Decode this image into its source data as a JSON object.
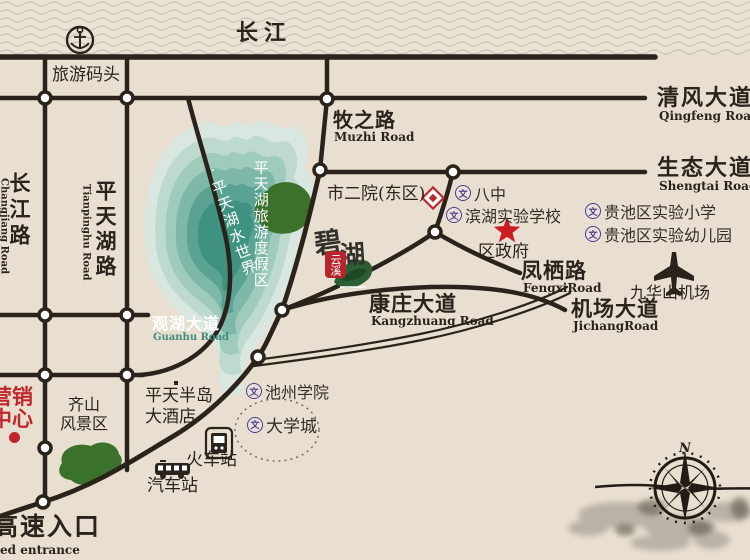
{
  "map": {
    "river": {
      "label": "长江"
    },
    "dock": {
      "label": "旅游码头"
    },
    "roads": {
      "muzhi": {
        "zh": "牧之路",
        "en": "Muzhi Road"
      },
      "qingfeng": {
        "zh": "清风大道",
        "en": "Qingfeng Road"
      },
      "shengtai": {
        "zh": "生态大道",
        "en": "Shengtai Road"
      },
      "changjiang": {
        "zh": "长江路",
        "en": "Changjiang Road"
      },
      "tianpinghu": {
        "zh": "平天湖路",
        "en": "Tianpinghu Road"
      },
      "guanhu": {
        "zh": "观湖大道",
        "en": "Guanhu Road"
      },
      "fengxi": {
        "zh": "凤栖路",
        "en": "FengxiRoad"
      },
      "jichang": {
        "zh": "机场大道",
        "en": "JichangRoad"
      },
      "kangzhuang": {
        "zh": "康庄大道",
        "en": "Kangzhuang Road"
      }
    },
    "lake": {
      "text1": "·平天湖水世界",
      "text2": "平天湖旅游度假区"
    },
    "pois": {
      "hospital": "市二院(东区)",
      "school_bazhong": "八中",
      "school_binhu": "滨湖实验学校",
      "school_primary": "贵池区实验小学",
      "school_kindergarten": "贵池区实验幼儿园",
      "government": "区政府",
      "airport": "九华山机场",
      "college": "池州学院",
      "university_town": "大学城",
      "train_station": "火车站",
      "bus_station": "汽车站",
      "hotel_line1": "平天半岛",
      "hotel_line2": "大酒店",
      "qishan_line1": "齐山",
      "qishan_line2": "风景区",
      "marketing_center": "营销中心",
      "highway_zh": "高速入口",
      "highway_en": "ed entrance"
    },
    "logo": {
      "char1": "碧",
      "char2": "湖",
      "seal": "云溪"
    },
    "compass": {
      "north": "N"
    },
    "colors": {
      "accent_red": "#c0272d",
      "school_purple": "#483b91",
      "lake_teal": "#3f8e7e",
      "road_dark": "#2a231b"
    }
  }
}
